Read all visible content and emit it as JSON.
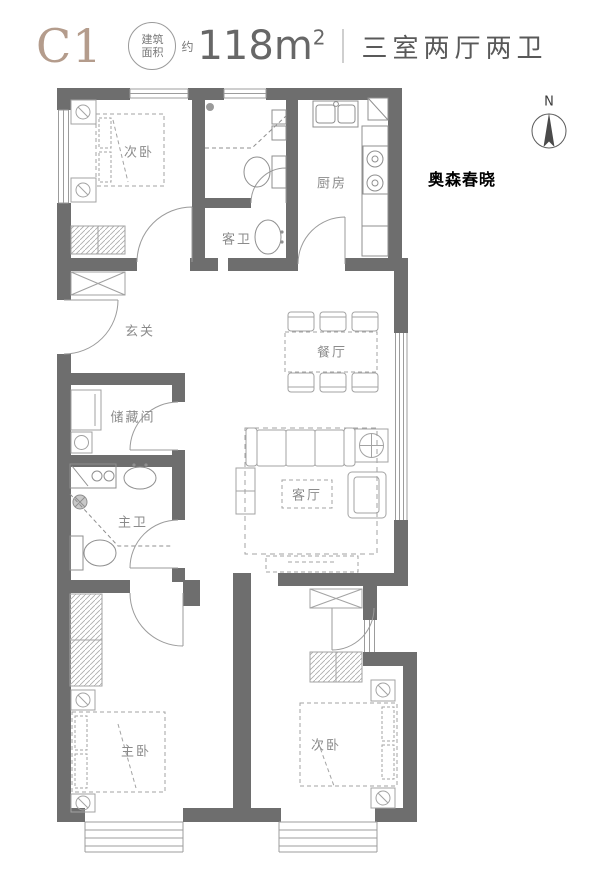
{
  "header": {
    "unit_label": "C1",
    "area_circle_line1": "建筑",
    "area_circle_line2": "面积",
    "area_approx": "约",
    "area_value": "118m",
    "area_sup": "2",
    "layout_text": "三室两厅两卫"
  },
  "compass": {
    "north_label": "N"
  },
  "watermark": "奥森春晓",
  "rooms": [
    {
      "id": "bedroom-top",
      "label": "次卧"
    },
    {
      "id": "guest-bath",
      "label": "客卫"
    },
    {
      "id": "kitchen",
      "label": "厨房"
    },
    {
      "id": "foyer",
      "label": "玄关"
    },
    {
      "id": "dining",
      "label": "餐厅"
    },
    {
      "id": "storage",
      "label": "储藏间"
    },
    {
      "id": "master-bath",
      "label": "主卫"
    },
    {
      "id": "living",
      "label": "客厅"
    },
    {
      "id": "master-bedroom",
      "label": "主卧"
    },
    {
      "id": "bedroom-bottom",
      "label": "次卧"
    }
  ]
}
